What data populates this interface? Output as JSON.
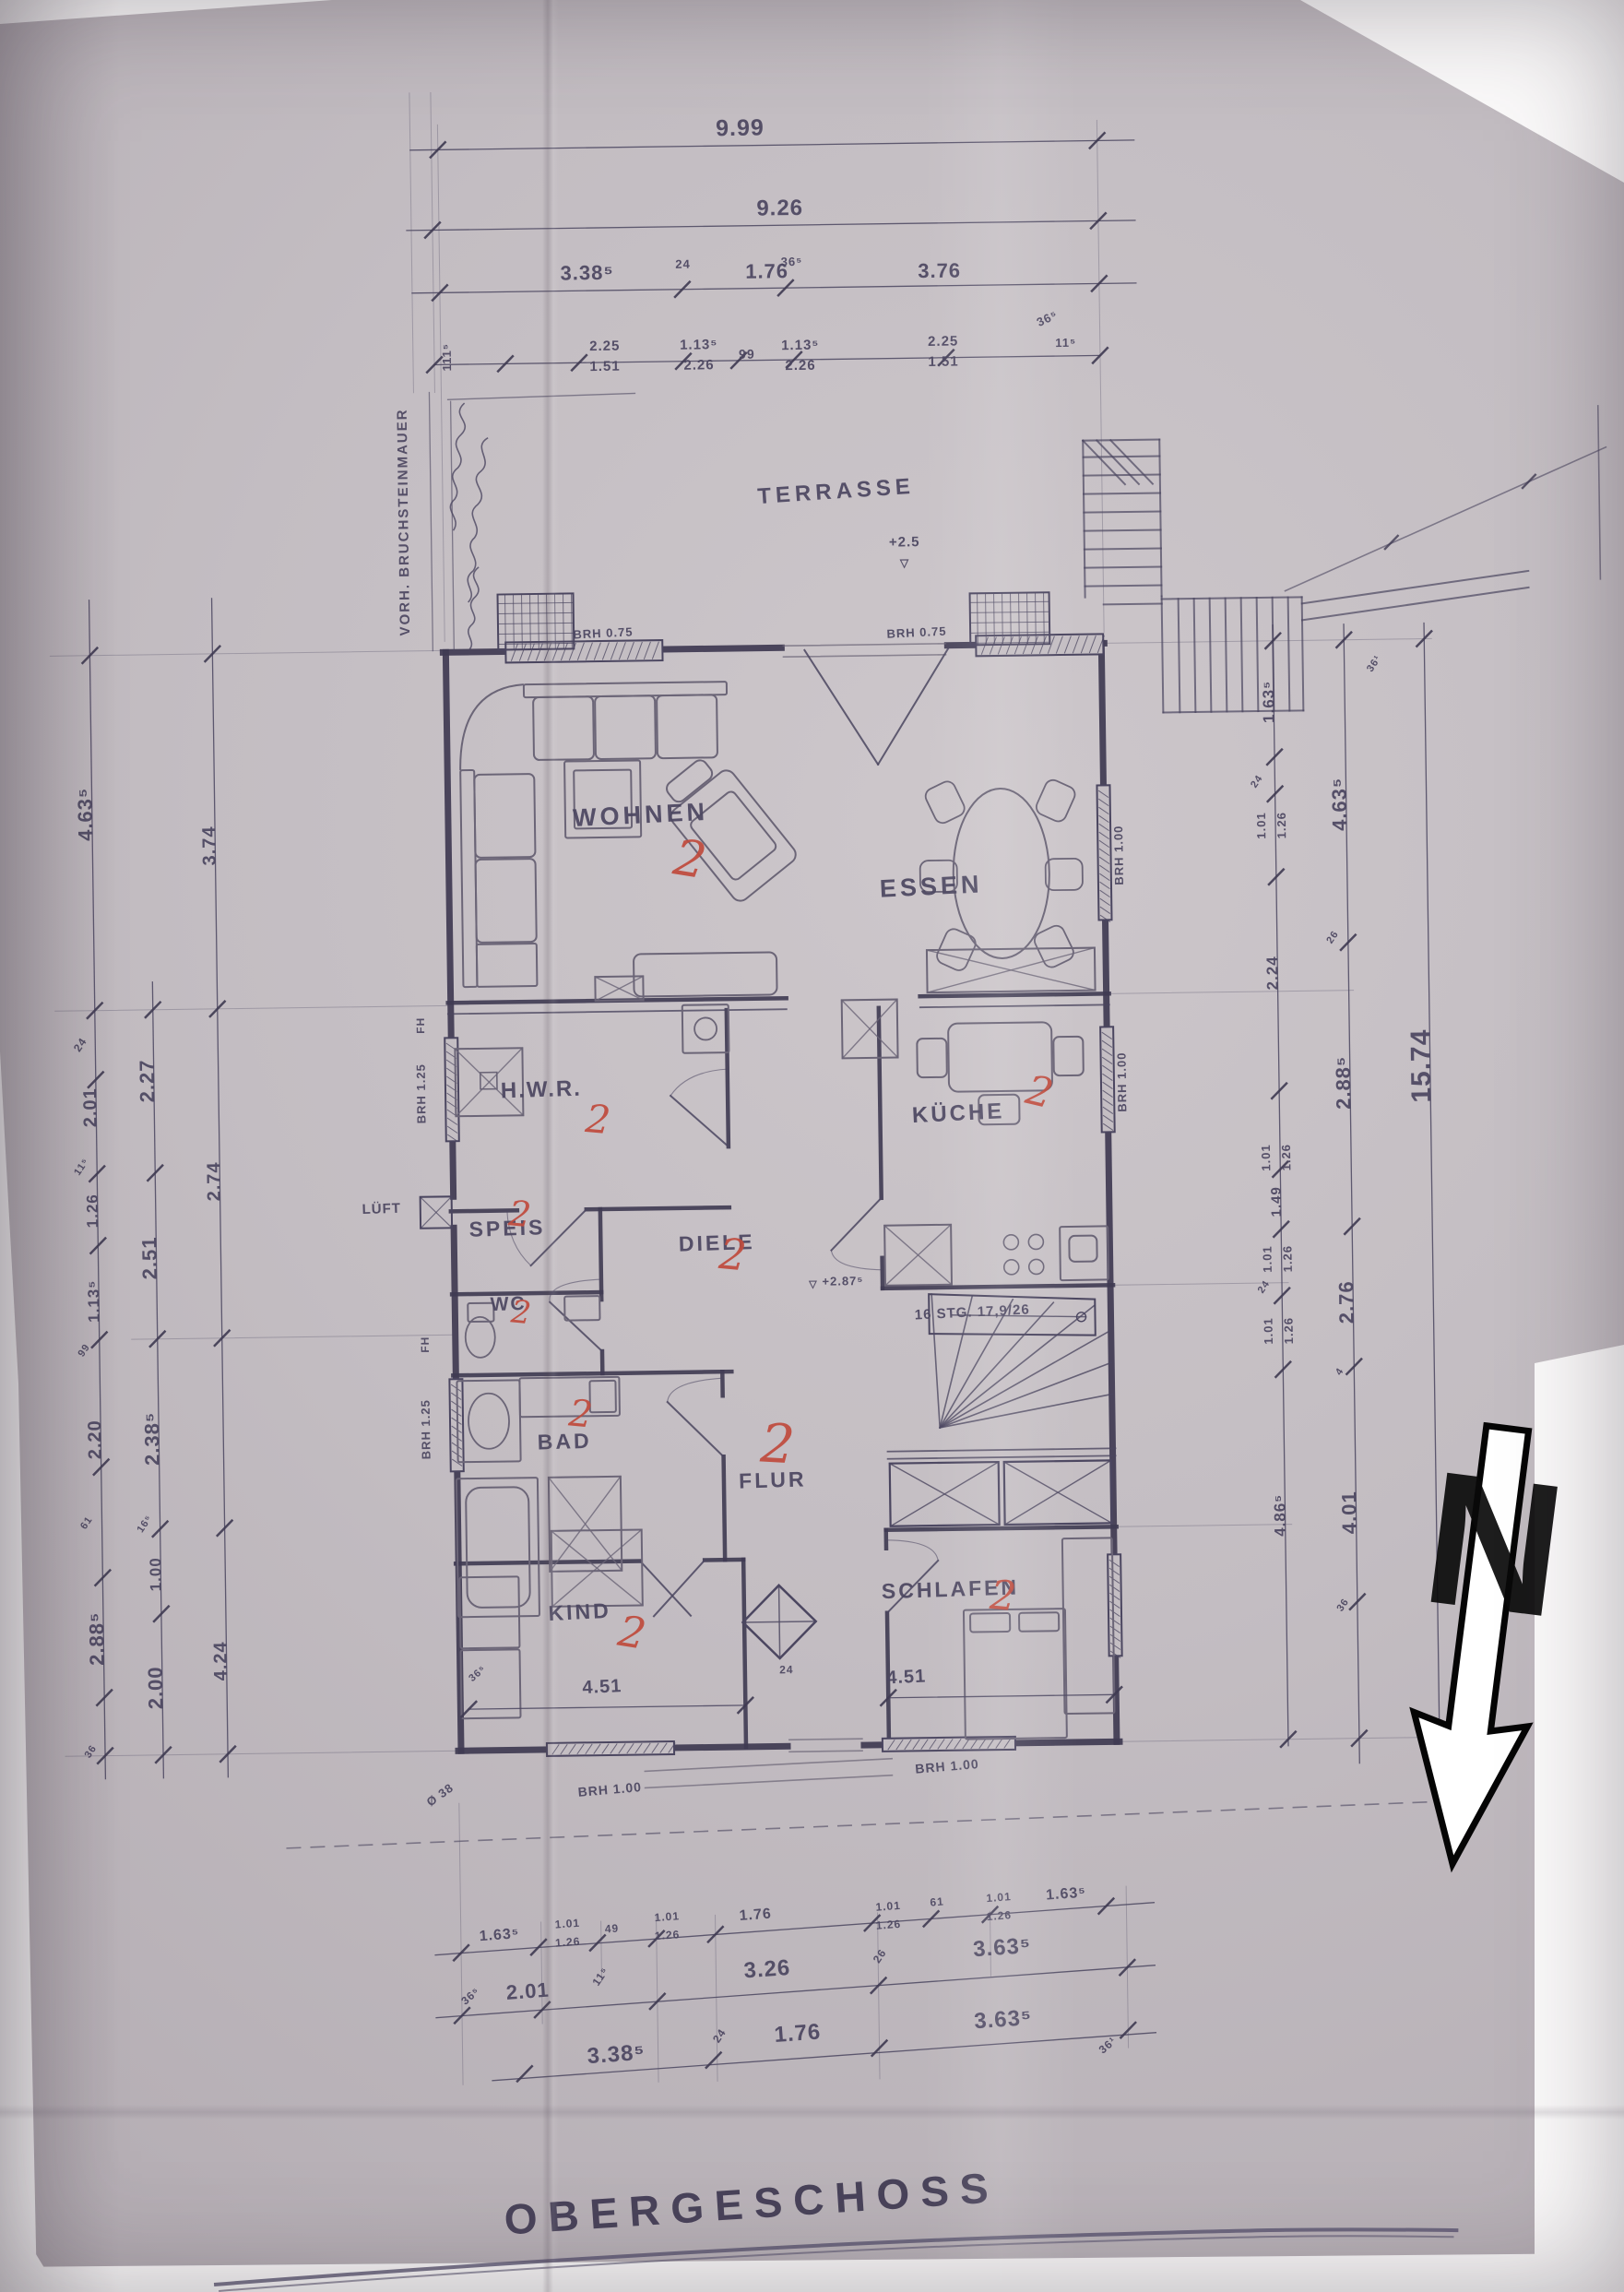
{
  "title": "OBERGESCHOSS",
  "north": "N",
  "rooms": {
    "terrasse": "TERRASSE",
    "wohnen": "WOHNEN",
    "essen": "ESSEN",
    "hwr": "H.W.R.",
    "kueche": "KÜCHE",
    "speis": "SPEIS",
    "diele": "DIELE",
    "wc": "WC",
    "bad": "BAD",
    "flur": "FLUR",
    "kind": "KIND",
    "schlafen": "SCHLAFEN",
    "lueft": "LÜFT"
  },
  "red_mark": "2",
  "dims": {
    "d999": "9.99",
    "d926": "9.26",
    "d338a": "3.38⁵",
    "d176a": "1.76",
    "d376": "3.76",
    "d225": "2.25",
    "d151": "1.51",
    "d113": "1.13⁵",
    "d226": "2.26",
    "s99": "99",
    "s24a": "24",
    "s36a": "36⁵",
    "s36b": "36⁵",
    "s11": "11⁵",
    "s111": "111⁵",
    "d463": "4.63⁵",
    "d201": "2.01",
    "d126": "1.26",
    "d220": "2.20",
    "d288": "2.88⁵",
    "d227": "2.27",
    "d251": "2.51",
    "d238": "2.38⁵",
    "d100": "1.00",
    "d200": "2.00",
    "d374": "3.74",
    "d274": "2.74",
    "d424": "4.24",
    "s61": "61",
    "s16": "16⁵",
    "s36c": "36",
    "d163": "1.63⁵",
    "d101": "1.01",
    "d126b": "1.26",
    "d224": "2.24",
    "d149": "1.49",
    "d486": "4.86⁵",
    "d276": "2.76",
    "d401": "4.01",
    "s26": "26",
    "s4": "4",
    "s16b": "36¹",
    "d1574": "15.74",
    "d326": "3.26",
    "d363": "3.63⁵",
    "s49": "49",
    "d451": "4.51"
  },
  "notes": {
    "stair": "16 STG. 17,9/26",
    "level1": "+2.5",
    "level2": "+2.87⁵",
    "tri": "▽",
    "brh075": "BRH 0.75",
    "brh100": "BRH 1.00",
    "brh125": "BRH 1.25",
    "fh": "FH",
    "wall": "VORH. BRUCHSTEINMAUER",
    "o38": "Ø 38"
  }
}
